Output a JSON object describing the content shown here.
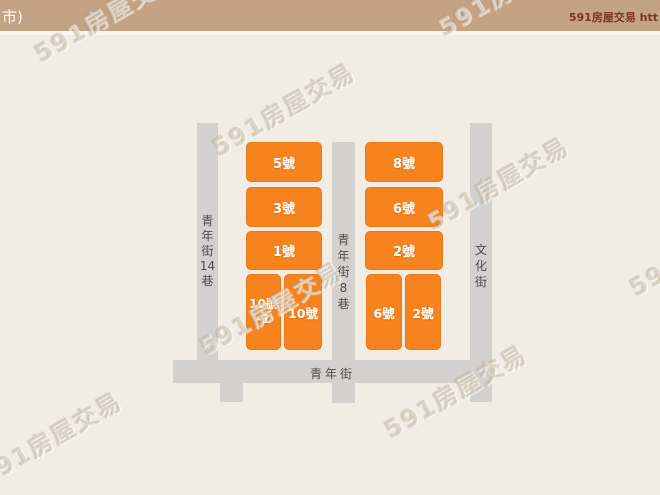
{
  "header": {
    "left_text": "市)",
    "right_text": "591房屋交易 htt",
    "bg_color": "#c4a384",
    "left_text_color": "#ffffff",
    "right_text_color": "#7a3428"
  },
  "watermark": {
    "text": "591房屋交易"
  },
  "map": {
    "bg_color": "#f1ece4",
    "street_color": "#d3d1ce",
    "street_label_color": "#4f4c49",
    "building_color": "#f6831d",
    "building_text_color": "#ffffff",
    "streets": {
      "left_vertical": {
        "name": "青年街14巷",
        "chars": [
          "青",
          "年",
          "街",
          "14",
          "巷"
        ]
      },
      "middle_vertical": {
        "name": "青年街8巷",
        "chars": [
          "青",
          "年",
          "街",
          "8",
          "巷"
        ]
      },
      "right_vertical": {
        "name": "文化街",
        "chars": [
          "文",
          "化",
          "街"
        ]
      },
      "bottom_horizontal": {
        "name": "青年街"
      }
    },
    "buildings": [
      {
        "label": "5號"
      },
      {
        "label": "3號"
      },
      {
        "label": "1號"
      },
      {
        "label": "10號-1",
        "line1": "10號",
        "line2": "-1"
      },
      {
        "label": "10號"
      },
      {
        "label": "8號"
      },
      {
        "label": "6號"
      },
      {
        "label": "2號"
      },
      {
        "label": "6號"
      },
      {
        "label": "2號"
      }
    ]
  }
}
